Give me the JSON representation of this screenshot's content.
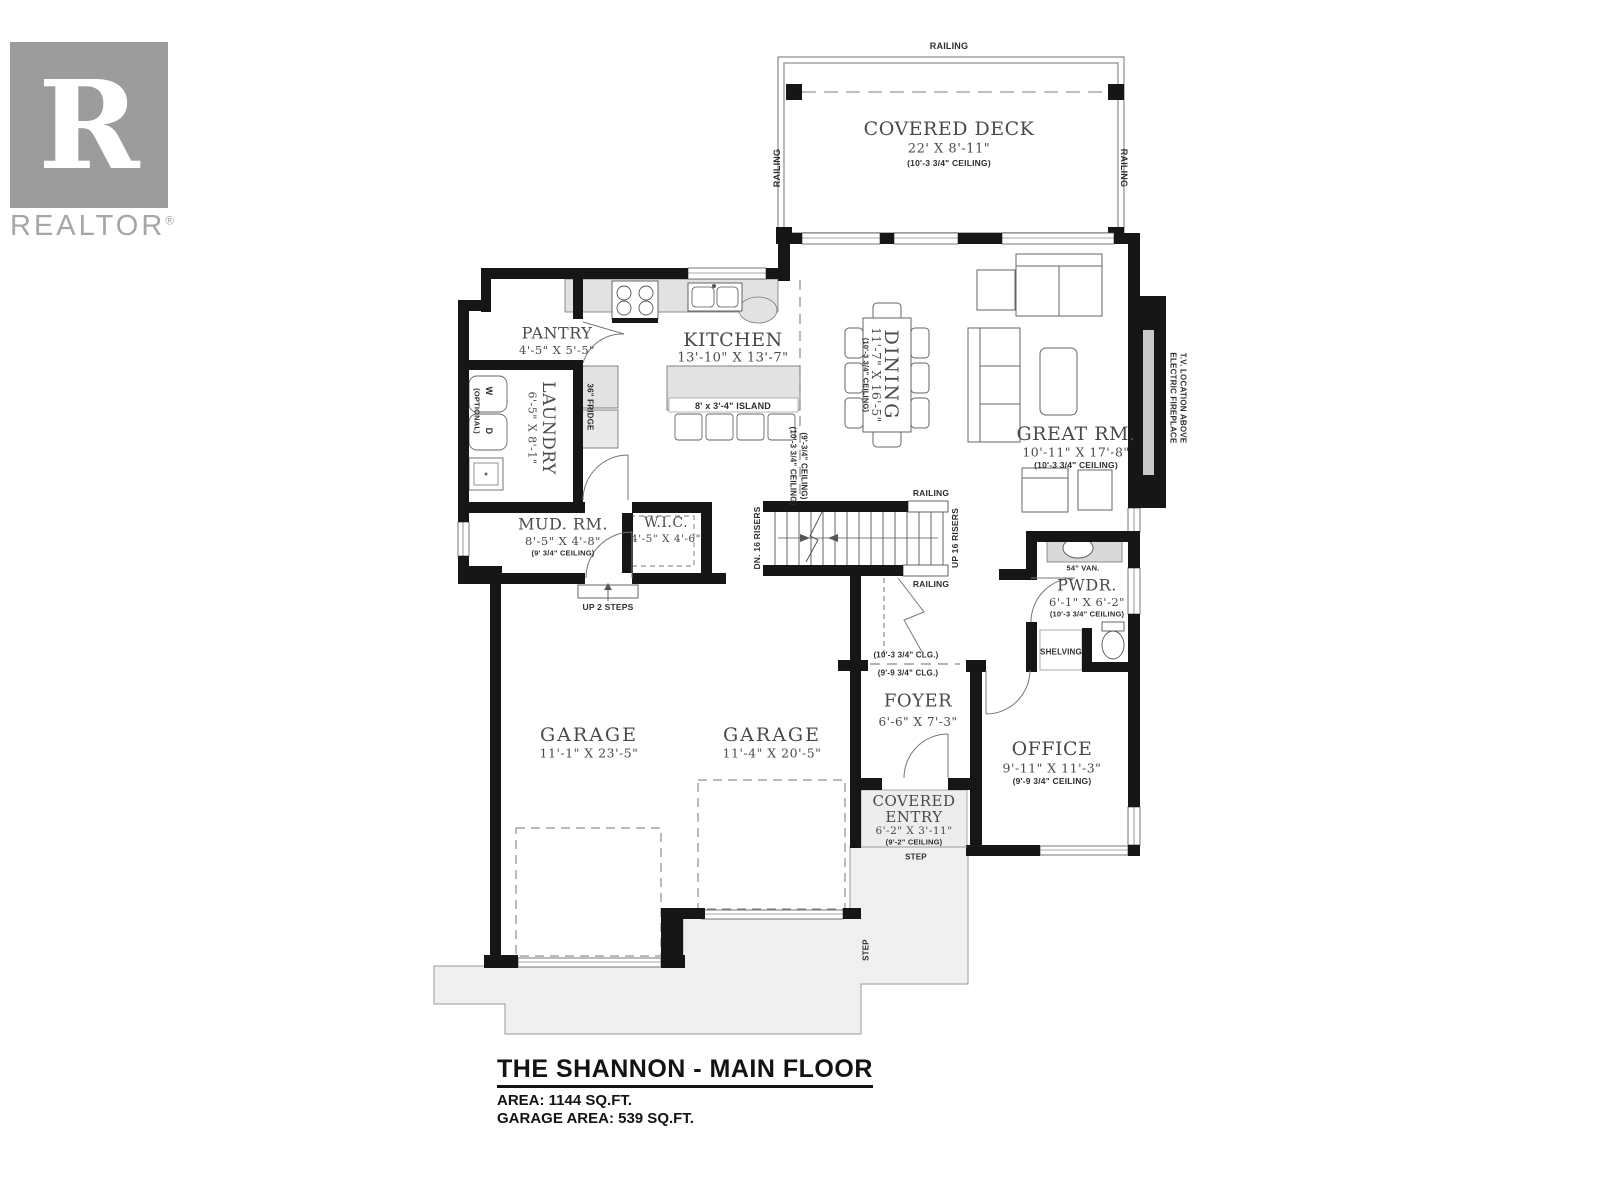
{
  "logo": {
    "brand": "REALTOR",
    "reg": "®",
    "monogram": "R"
  },
  "title_block": {
    "title": "THE SHANNON - MAIN FLOOR",
    "area": "AREA: 1144 SQ.FT.",
    "garage_area": "GARAGE AREA:  539 SQ.FT."
  },
  "rooms": {
    "deck": {
      "name": "COVERED DECK",
      "dims": "22' X 8'-11\""
    },
    "kitchen": {
      "name": "KITCHEN",
      "dims": "13'-10\" X 13'-7\""
    },
    "pantry": {
      "name": "PANTRY",
      "dims": "4'-5\" X 5'-5\""
    },
    "laundry": {
      "name": "LAUNDRY",
      "dims": "6'-5\" X 8'-1\""
    },
    "dining": {
      "name": "DINING",
      "dims": "11'-7\" X 16'-5\""
    },
    "great_room": {
      "name": "GREAT RM.",
      "dims": "10'-11\" X 17'-8\""
    },
    "mud_room": {
      "name": "MUD. RM.",
      "dims": "8'-5\" X 4'-8\"",
      "ceiling": "(9' 3/4\" CEILING)"
    },
    "wic": {
      "name": "W.I.C.",
      "dims": "4'-5\" X 4'-6\""
    },
    "pwdr": {
      "name": "PWDR.",
      "dims": "6'-1\" X 6'-2\""
    },
    "foyer": {
      "name": "FOYER",
      "dims": "6'-6\" X 7'-3\""
    },
    "office": {
      "name": "OFFICE",
      "dims": "9'-11\" X 11'-3\"",
      "ceiling": "(9'-9 3/4\" CEILING)"
    },
    "entry": {
      "name1": "COVERED",
      "name2": "ENTRY",
      "dims": "6'-2\" X 3'-11\"",
      "ceiling": "(9'-2\" CEILING)"
    },
    "garage_left": {
      "name": "GARAGE",
      "dims": "11'-1\" X 23'-5\""
    },
    "garage_right": {
      "name": "GARAGE",
      "dims": "11'-4\" X 20'-5\""
    }
  },
  "labels": {
    "railing": "RAILING",
    "ceiling_10_3_34": "(10'-3 3/4\" CEILING)",
    "ceiling_9_34": "(9'-3/4\" CEILING)",
    "clg_10": "(10'-3 3/4\" CLG.)",
    "clg_9": "(9'-9 3/4\" CLG.)",
    "dn_risers": "DN. 16 RISERS",
    "up_risers": "UP 16 RISERS",
    "up_2_steps": "UP 2 STEPS",
    "island": "8' x 3'-4\" ISLAND",
    "fridge": "36\" FRIDGE",
    "washer": "W",
    "dryer": "D",
    "optional": "(OPTIONAL)",
    "vanity": "54\" VAN.",
    "shelving": "SHELVING",
    "step": "STEP",
    "fireplace_1": "ELECTRIC FIREPLACE",
    "fireplace_2": "T.V. LOCATION ABOVE"
  },
  "colors": {
    "wall": "#161616",
    "line": "#666666",
    "counter": "#e2e2e2",
    "concrete": "#f0f0f0",
    "logo_gray": "#9c9c9c"
  }
}
